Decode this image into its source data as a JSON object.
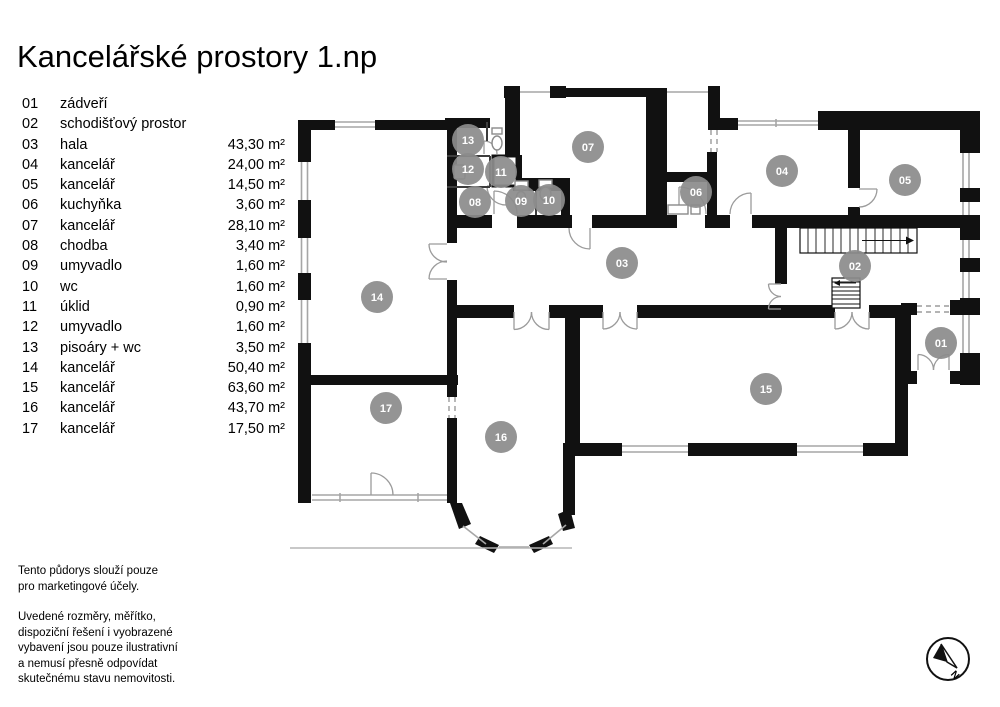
{
  "title": "Kancelářské prostory 1.np",
  "legend": {
    "items": [
      {
        "num": "01",
        "name": "zádveří",
        "area": ""
      },
      {
        "num": "02",
        "name": "schodišťový prostor",
        "area": ""
      },
      {
        "num": "03",
        "name": "hala",
        "area": "43,30 m²"
      },
      {
        "num": "04",
        "name": "kancelář",
        "area": "24,00 m²"
      },
      {
        "num": "05",
        "name": "kancelář",
        "area": "14,50 m²"
      },
      {
        "num": "06",
        "name": "kuchyňka",
        "area": "3,60 m²"
      },
      {
        "num": "07",
        "name": "kancelář",
        "area": "28,10 m²"
      },
      {
        "num": "08",
        "name": "chodba",
        "area": "3,40 m²"
      },
      {
        "num": "09",
        "name": "umyvadlo",
        "area": "1,60 m²"
      },
      {
        "num": "10",
        "name": "wc",
        "area": "1,60 m²"
      },
      {
        "num": "11",
        "name": "úklid",
        "area": "0,90 m²"
      },
      {
        "num": "12",
        "name": "umyvadlo",
        "area": "1,60 m²"
      },
      {
        "num": "13",
        "name": "pisoáry + wc",
        "area": "3,50 m²"
      },
      {
        "num": "14",
        "name": "kancelář",
        "area": "50,40 m²"
      },
      {
        "num": "15",
        "name": "kancelář",
        "area": "63,60 m²"
      },
      {
        "num": "16",
        "name": "kancelář",
        "area": "43,70 m²"
      },
      {
        "num": "17",
        "name": "kancelář",
        "area": "17,50 m²"
      }
    ]
  },
  "notes": {
    "note1": "Tento půdorys slouží pouze\npro marketingové účely.",
    "note2": "Uvedené rozměry, měřítko,\ndispoziční řešení i vyobrazené\nvybavení jsou pouze ilustrativní\na nemusí přesně odpovídat\nskutečnému stavu nemovitosti."
  },
  "compass": {
    "label": "N"
  },
  "plan": {
    "badge_radius": 16,
    "rooms": [
      {
        "id": "01",
        "x": 941,
        "y": 343
      },
      {
        "id": "02",
        "x": 855,
        "y": 266
      },
      {
        "id": "03",
        "x": 622,
        "y": 263
      },
      {
        "id": "04",
        "x": 782,
        "y": 171
      },
      {
        "id": "05",
        "x": 905,
        "y": 180
      },
      {
        "id": "06",
        "x": 696,
        "y": 192
      },
      {
        "id": "07",
        "x": 588,
        "y": 147
      },
      {
        "id": "08",
        "x": 475,
        "y": 202
      },
      {
        "id": "09",
        "x": 521,
        "y": 201
      },
      {
        "id": "10",
        "x": 549,
        "y": 200
      },
      {
        "id": "11",
        "x": 501,
        "y": 172
      },
      {
        "id": "12",
        "x": 468,
        "y": 169
      },
      {
        "id": "13",
        "x": 468,
        "y": 140
      },
      {
        "id": "14",
        "x": 377,
        "y": 297
      },
      {
        "id": "15",
        "x": 766,
        "y": 389
      },
      {
        "id": "16",
        "x": 501,
        "y": 437
      },
      {
        "id": "17",
        "x": 386,
        "y": 408
      }
    ]
  },
  "colors": {
    "wall": "#111111",
    "window": "#a6a6a6",
    "badge": "#8c8c8c",
    "badge_text": "#ffffff"
  }
}
